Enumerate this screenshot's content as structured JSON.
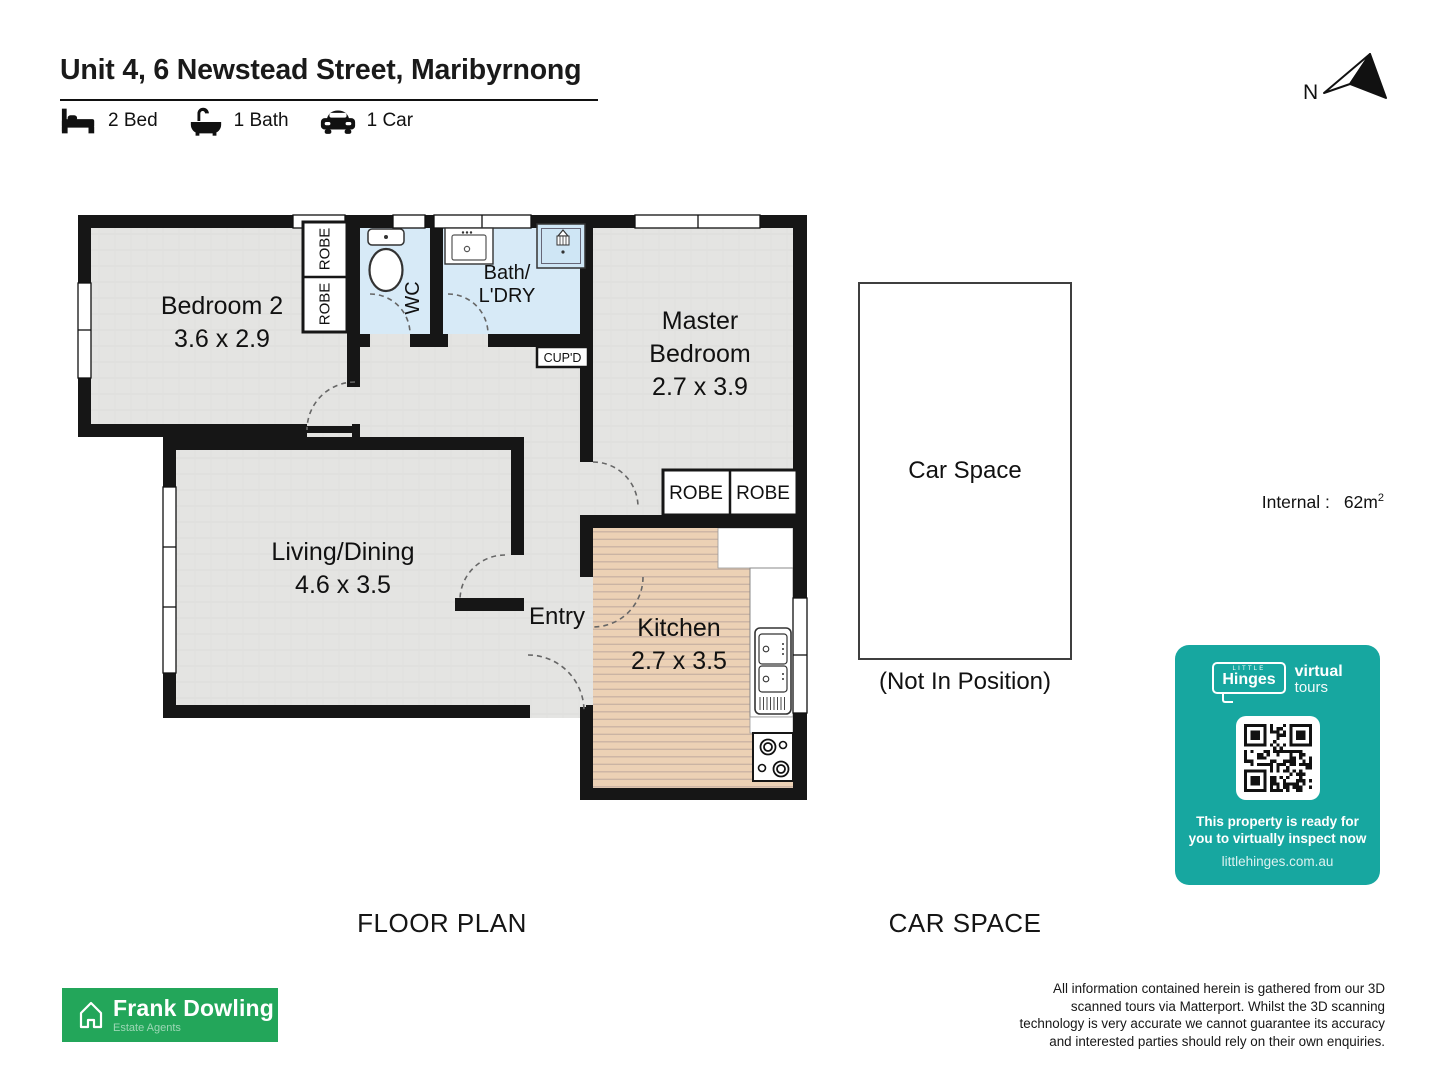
{
  "header": {
    "title": "Unit 4, 6 Newstead Street, Maribyrnong",
    "features": [
      {
        "icon": "bed-icon",
        "label": "2 Bed"
      },
      {
        "icon": "bath-icon",
        "label": "1 Bath"
      },
      {
        "icon": "car-icon",
        "label": "1 Car"
      }
    ]
  },
  "compass": {
    "label": "N"
  },
  "floor_plan": {
    "section_label": "FLOOR PLAN",
    "rooms": {
      "bedroom2": {
        "name": "Bedroom 2",
        "dims": "3.6 x 2.9"
      },
      "master": {
        "name_line1": "Master",
        "name_line2": "Bedroom",
        "dims": "2.7 x 3.9"
      },
      "living": {
        "name": "Living/Dining",
        "dims": "4.6 x 3.5"
      },
      "kitchen": {
        "name": "Kitchen",
        "dims": "2.7 x 3.5"
      },
      "bath": {
        "name_line1": "Bath/",
        "name_line2": "L'DRY"
      },
      "wc": {
        "name": "WC"
      },
      "entry": {
        "name": "Entry"
      }
    },
    "fixtures": {
      "robe": "ROBE",
      "cupboard": "CUP'D"
    }
  },
  "car_space": {
    "section_label": "CAR SPACE",
    "label": "Car Space",
    "note": "(Not In Position)"
  },
  "area": {
    "label": "Internal :",
    "value": "62m",
    "superscript": "2"
  },
  "badge": {
    "color": "#17a7a0",
    "logo_small": "LITTLE",
    "logo_main": "Hinges",
    "logo_right_bold": "virtual",
    "logo_right": "tours",
    "message_line1": "This property is ready for",
    "message_line2": "you to virtually inspect now",
    "url": "littlehinges.com.au"
  },
  "agency": {
    "color": "#23a65a",
    "name": "Frank Dowling",
    "tagline": "Estate Agents"
  },
  "disclaimer": {
    "lines": [
      "All information contained herein is gathered from our 3D",
      "scanned tours via Matterport. Whilst the 3D scanning",
      "technology is very accurate we cannot guarantee its accuracy",
      "and interested parties should rely on their own enquiries."
    ]
  }
}
